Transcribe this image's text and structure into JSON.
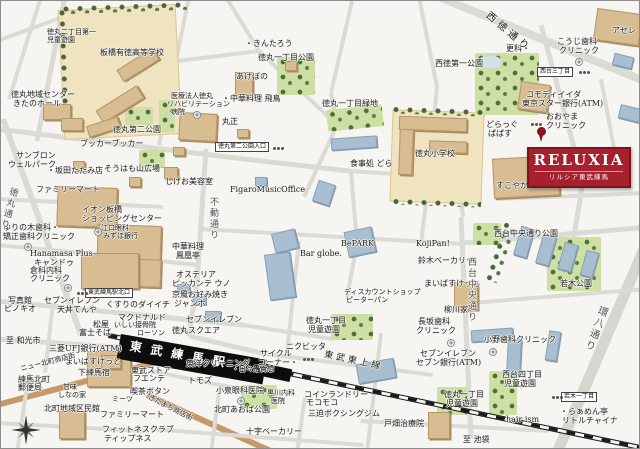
{
  "badge": {
    "title": "RELUXIA",
    "subtitle": "リルシア東武練馬",
    "bg": "#a6202e"
  },
  "station": {
    "name": "東武練馬駅"
  },
  "railway": {
    "name": "東武東上線",
    "dest_left": "至 和光市",
    "dest_right": "至 池袋"
  },
  "sign_boxes": [
    {
      "t": "東武練馬駅北口",
      "x": 84,
      "y": 287
    },
    {
      "t": "徳丸第二公園入口",
      "x": 214,
      "y": 141
    },
    {
      "t": "西台三丁目",
      "x": 536,
      "y": 66
    },
    {
      "t": "若木一丁目",
      "x": 560,
      "y": 391
    }
  ],
  "medical_icons": [
    [
      192,
      110
    ],
    [
      93,
      227
    ],
    [
      23,
      242
    ],
    [
      63,
      283
    ],
    [
      574,
      57
    ],
    [
      446,
      338
    ],
    [
      488,
      347
    ],
    [
      236,
      396
    ]
  ],
  "signal_icons": [
    [
      76,
      291
    ],
    [
      272,
      146
    ],
    [
      578,
      70
    ],
    [
      551,
      395
    ],
    [
      302,
      357
    ],
    [
      530,
      122
    ]
  ],
  "roads": [
    [
      438,
      -4,
      648,
      82,
      8,
      "g"
    ],
    [
      40,
      -4,
      8,
      98,
      4,
      "g"
    ],
    [
      -4,
      40,
      62,
      16,
      4,
      "g"
    ],
    [
      64,
      -4,
      36,
      140,
      5,
      "g"
    ],
    [
      188,
      -4,
      158,
      144,
      4,
      "g"
    ],
    [
      -4,
      128,
      226,
      156,
      5,
      "g"
    ],
    [
      226,
      156,
      348,
      170,
      5,
      "g"
    ],
    [
      348,
      170,
      442,
      176,
      4,
      "g"
    ],
    [
      160,
      62,
      258,
      50,
      4,
      "g"
    ],
    [
      225,
      -4,
      258,
      50,
      4,
      "g"
    ],
    [
      258,
      50,
      336,
      124,
      4,
      "g"
    ],
    [
      352,
      -4,
      330,
      92,
      4,
      "g"
    ],
    [
      330,
      92,
      336,
      124,
      4,
      "g"
    ],
    [
      336,
      124,
      303,
      196,
      4,
      "g"
    ],
    [
      205,
      148,
      196,
      282,
      5,
      "g"
    ],
    [
      196,
      282,
      188,
      335,
      5,
      "g"
    ],
    [
      436,
      84,
      428,
      176,
      4,
      "g"
    ],
    [
      428,
      176,
      420,
      243,
      4,
      "g"
    ],
    [
      540,
      24,
      582,
      180,
      5,
      "g"
    ],
    [
      582,
      180,
      572,
      242,
      5,
      "g"
    ],
    [
      418,
      -4,
      436,
      86,
      4,
      "g"
    ],
    [
      648,
      236,
      556,
      452,
      11,
      "w"
    ],
    [
      456,
      160,
      462,
      216,
      4,
      "g"
    ],
    [
      460,
      216,
      470,
      438,
      5,
      "g"
    ],
    [
      200,
      228,
      463,
      243,
      4,
      "g"
    ],
    [
      -4,
      244,
      82,
      252,
      4,
      "g"
    ],
    [
      82,
      252,
      197,
      264,
      4,
      "g"
    ],
    [
      -4,
      300,
      242,
      324,
      5,
      "g"
    ],
    [
      242,
      324,
      332,
      338,
      4,
      "g"
    ],
    [
      -4,
      338,
      128,
      347,
      5,
      "g"
    ],
    [
      -4,
      404,
      160,
      360,
      6,
      "b"
    ],
    [
      146,
      394,
      274,
      452,
      6,
      "b"
    ],
    [
      28,
      372,
      16,
      452,
      4,
      "g"
    ],
    [
      -4,
      422,
      142,
      430,
      4,
      "g"
    ],
    [
      52,
      302,
      44,
      372,
      4,
      "g"
    ],
    [
      150,
      370,
      258,
      392,
      4,
      "g"
    ],
    [
      218,
      392,
      210,
      452,
      4,
      "g"
    ],
    [
      150,
      428,
      362,
      444,
      4,
      "g"
    ],
    [
      304,
      396,
      296,
      452,
      4,
      "g"
    ],
    [
      298,
      240,
      286,
      352,
      4,
      "g"
    ],
    [
      350,
      170,
      356,
      243,
      4,
      "g"
    ],
    [
      356,
      243,
      346,
      296,
      4,
      "g"
    ],
    [
      462,
      242,
      648,
      226,
      5,
      "g"
    ],
    [
      470,
      302,
      645,
      288,
      4,
      "g"
    ],
    [
      495,
      198,
      648,
      192,
      4,
      "g"
    ],
    [
      600,
      78,
      620,
      184,
      4,
      "g"
    ],
    [
      -4,
      198,
      162,
      206,
      4,
      "g"
    ],
    [
      2,
      118,
      80,
      334,
      6,
      "g"
    ],
    [
      258,
      352,
      432,
      374,
      4,
      "g"
    ],
    [
      360,
      420,
      548,
      430,
      4,
      "g"
    ],
    [
      380,
      332,
      366,
      452,
      4,
      "g"
    ],
    [
      188,
      335,
      260,
      352,
      5,
      "g"
    ]
  ],
  "grounds": [
    [
      60,
      6,
      118,
      130,
      -3
    ],
    [
      390,
      110,
      92,
      92,
      2
    ]
  ],
  "parks": [
    [
      276,
      56,
      38,
      38,
      0
    ],
    [
      326,
      106,
      56,
      22,
      -6
    ],
    [
      474,
      52,
      64,
      62,
      0
    ],
    [
      124,
      106,
      28,
      18,
      0
    ],
    [
      138,
      149,
      26,
      18,
      0
    ],
    [
      472,
      222,
      28,
      22,
      0
    ],
    [
      546,
      236,
      54,
      54,
      0
    ],
    [
      240,
      384,
      36,
      24,
      0
    ],
    [
      330,
      313,
      42,
      26,
      0
    ],
    [
      436,
      386,
      30,
      28,
      0
    ],
    [
      488,
      370,
      28,
      44,
      0
    ],
    [
      158,
      99,
      16,
      32,
      0
    ]
  ],
  "tree_strips": [
    [
      60,
      2,
      126,
      9,
      -2
    ],
    [
      58,
      8,
      8,
      120,
      -2
    ],
    [
      390,
      106,
      94,
      8,
      2
    ],
    [
      390,
      198,
      90,
      7,
      2
    ],
    [
      492,
      220,
      16,
      62,
      18
    ]
  ],
  "ponds": [
    [
      478,
      55,
      22,
      12
    ]
  ],
  "buildings_tan": [
    [
      95,
      96,
      48,
      15,
      -32
    ],
    [
      116,
      57,
      42,
      14,
      -32
    ],
    [
      86,
      120,
      33,
      12,
      -18
    ],
    [
      398,
      116,
      68,
      14,
      2
    ],
    [
      398,
      128,
      14,
      46,
      2
    ],
    [
      428,
      140,
      38,
      12,
      2
    ],
    [
      42,
      103,
      28,
      16,
      0
    ],
    [
      60,
      117,
      22,
      13,
      0
    ],
    [
      178,
      112,
      38,
      28,
      3
    ],
    [
      56,
      186,
      60,
      40,
      2
    ],
    [
      96,
      224,
      64,
      46,
      2
    ],
    [
      118,
      258,
      42,
      28,
      2
    ],
    [
      80,
      252,
      58,
      36,
      0
    ],
    [
      492,
      156,
      66,
      40,
      -3
    ],
    [
      518,
      82,
      30,
      28,
      8
    ],
    [
      594,
      10,
      46,
      32,
      8
    ],
    [
      234,
      71,
      18,
      26,
      0
    ],
    [
      86,
      350,
      44,
      36,
      0
    ],
    [
      58,
      410,
      26,
      28,
      0
    ],
    [
      453,
      281,
      24,
      28,
      0
    ],
    [
      427,
      411,
      22,
      27,
      0
    ],
    [
      163,
      166,
      14,
      12,
      0
    ],
    [
      128,
      176,
      12,
      10,
      0
    ],
    [
      72,
      160,
      12,
      10,
      0
    ],
    [
      236,
      128,
      12,
      9,
      0
    ],
    [
      172,
      146,
      12,
      9,
      0
    ],
    [
      100,
      354,
      20,
      14,
      0
    ],
    [
      284,
      60,
      12,
      10,
      0
    ]
  ],
  "buildings_blue": [
    [
      266,
      252,
      26,
      46,
      -8
    ],
    [
      272,
      230,
      24,
      20,
      -14
    ],
    [
      314,
      181,
      18,
      22,
      18
    ],
    [
      330,
      136,
      46,
      12,
      -4
    ],
    [
      345,
      228,
      28,
      26,
      -12
    ],
    [
      516,
      226,
      14,
      30,
      16
    ],
    [
      538,
      234,
      14,
      30,
      16
    ],
    [
      560,
      242,
      14,
      28,
      16
    ],
    [
      582,
      250,
      13,
      26,
      16
    ],
    [
      470,
      328,
      42,
      12,
      -4
    ],
    [
      506,
      338,
      14,
      36,
      3
    ],
    [
      546,
      330,
      12,
      30,
      9
    ],
    [
      356,
      360,
      38,
      20,
      -10
    ],
    [
      204,
      310,
      16,
      10,
      0
    ],
    [
      176,
      283,
      13,
      9,
      0
    ],
    [
      192,
      295,
      13,
      9,
      0
    ],
    [
      618,
      106,
      26,
      14,
      14
    ],
    [
      612,
      54,
      20,
      12,
      14
    ],
    [
      254,
      176,
      12,
      9,
      0
    ]
  ],
  "labels": [
    {
      "t": "徳丸二丁目第一",
      "x": 46,
      "y": 28,
      "s": 7
    },
    {
      "t": "児童遊園",
      "x": 46,
      "y": 36,
      "s": 7
    },
    {
      "t": "板橋有徳高等学校",
      "x": 99,
      "y": 48
    },
    {
      "t": "徳丸地域センター",
      "x": 10,
      "y": 90
    },
    {
      "t": "きたのホール",
      "x": 12,
      "y": 99
    },
    {
      "t": "医療法人徳丸",
      "x": 170,
      "y": 92,
      "s": 7
    },
    {
      "t": "リハビリテーション",
      "x": 166,
      "y": 100,
      "s": 7
    },
    {
      "t": "病院",
      "x": 170,
      "y": 108,
      "s": 7
    },
    {
      "t": "徳丸第二公園",
      "x": 112,
      "y": 125
    },
    {
      "t": "ブッカーブッカー",
      "x": 79,
      "y": 139
    },
    {
      "t": "サンブロン",
      "x": 15,
      "y": 151
    },
    {
      "t": "ウェルパーク",
      "x": 7,
      "y": 160
    },
    {
      "t": "・坂田たたみ店",
      "x": 46,
      "y": 166
    },
    {
      "t": "そうはも山広場",
      "x": 103,
      "y": 164
    },
    {
      "t": "しげお美容室",
      "x": 164,
      "y": 177
    },
    {
      "t": "ファミリーマート",
      "x": 35,
      "y": 185
    },
    {
      "t": "イオン板橋",
      "x": 81,
      "y": 205
    },
    {
      "t": "ショッピングセンター",
      "x": 81,
      "y": 214
    },
    {
      "t": "江口眼科",
      "x": 100,
      "y": 224,
      "s": 7
    },
    {
      "t": "みずほ銀行",
      "x": 102,
      "y": 232,
      "s": 7
    },
    {
      "t": "ゆりの木歯科・",
      "x": 2,
      "y": 223
    },
    {
      "t": "矯正歯科クリニック",
      "x": 2,
      "y": 232
    },
    {
      "t": "Hanamasa Plus",
      "x": 29,
      "y": 249,
      "c": "en"
    },
    {
      "t": "キャンドゥ",
      "x": 33,
      "y": 258
    },
    {
      "t": "倉科内科",
      "x": 29,
      "y": 266
    },
    {
      "t": "クリニック",
      "x": 29,
      "y": 274
    },
    {
      "t": "写真館",
      "x": 7,
      "y": 296
    },
    {
      "t": "ピノキオ",
      "x": 3,
      "y": 304
    },
    {
      "t": "セブンイレブン",
      "x": 43,
      "y": 296
    },
    {
      "t": "天丼てんや",
      "x": 56,
      "y": 305
    },
    {
      "t": "くすりのダイイチ",
      "x": 105,
      "y": 300
    },
    {
      "t": "マクドナルド",
      "x": 117,
      "y": 313
    },
    {
      "t": "いしい接骨院",
      "x": 113,
      "y": 321,
      "s": 7
    },
    {
      "t": "松屋",
      "x": 92,
      "y": 320
    },
    {
      "t": "富士そば",
      "x": 78,
      "y": 328
    },
    {
      "t": "ローソン",
      "x": 136,
      "y": 329,
      "s": 7
    },
    {
      "t": "三菱UFJ銀行(ATM)",
      "x": 48,
      "y": 344
    },
    {
      "t": "まいばすけっと",
      "x": 64,
      "y": 357
    },
    {
      "t": "下練馬宿",
      "x": 77,
      "y": 368
    },
    {
      "t": "練馬北町",
      "x": 17,
      "y": 375
    },
    {
      "t": "郵便局",
      "x": 17,
      "y": 383
    },
    {
      "t": "甘味",
      "x": 62,
      "y": 383,
      "s": 7
    },
    {
      "t": "しなの家",
      "x": 57,
      "y": 391,
      "s": 7
    },
    {
      "t": "北町地域区民館",
      "x": 43,
      "y": 404
    },
    {
      "t": "ミーツ",
      "x": 111,
      "y": 395,
      "s": 7
    },
    {
      "t": "ファミリーマート",
      "x": 99,
      "y": 410
    },
    {
      "t": "フィットネスクラブ",
      "x": 101,
      "y": 425
    },
    {
      "t": "ティップネス",
      "x": 103,
      "y": 434
    },
    {
      "t": "東武ストア",
      "x": 130,
      "y": 366
    },
    {
      "t": "フエンテ",
      "x": 132,
      "y": 374
    },
    {
      "t": "喫茶ボタン",
      "x": 129,
      "y": 387
    },
    {
      "t": "トモズ",
      "x": 187,
      "y": 376
    },
    {
      "t": "東洋クリーニング",
      "x": 185,
      "y": 359
    },
    {
      "t": "小泉眼科医院",
      "x": 215,
      "y": 386
    },
    {
      "t": "北町あおば公園",
      "x": 213,
      "y": 405
    },
    {
      "t": "黒川内科",
      "x": 266,
      "y": 389,
      "s": 7
    },
    {
      "t": "医院",
      "x": 270,
      "y": 397,
      "s": 7
    },
    {
      "t": "コインランドリー",
      "x": 303,
      "y": 390
    },
    {
      "t": "モコモコ",
      "x": 305,
      "y": 398
    },
    {
      "t": "三迫ボクシングジム",
      "x": 307,
      "y": 409
    },
    {
      "t": "十字ベーカリー",
      "x": 245,
      "y": 427
    },
    {
      "t": "・日々是貴想",
      "x": 231,
      "y": 365,
      "s": 7
    },
    {
      "t": "サイクル",
      "x": 259,
      "y": 349
    },
    {
      "t": "コーナー・",
      "x": 257,
      "y": 358
    },
    {
      "t": "ニクビッタ",
      "x": 285,
      "y": 342
    },
    {
      "t": "徳丸スクエア",
      "x": 171,
      "y": 326
    },
    {
      "t": "セブンイレブン",
      "x": 185,
      "y": 315
    },
    {
      "t": "京風お好み焼き",
      "x": 171,
      "y": 290
    },
    {
      "t": "ジャンボ",
      "x": 173,
      "y": 299
    },
    {
      "t": "オステリア",
      "x": 175,
      "y": 270
    },
    {
      "t": "ピッカンテ ウノ",
      "x": 171,
      "y": 279
    },
    {
      "t": "中華料理",
      "x": 171,
      "y": 242
    },
    {
      "t": "鳳凰亭",
      "x": 175,
      "y": 251
    },
    {
      "t": "FigaroMusicOffice",
      "x": 229,
      "y": 185,
      "c": "en"
    },
    {
      "t": "Bar globe.",
      "x": 299,
      "y": 249,
      "c": "en"
    },
    {
      "t": "BePARK",
      "x": 340,
      "y": 239,
      "c": "en"
    },
    {
      "t": "KojiPan!",
      "x": 415,
      "y": 239,
      "c": "en"
    },
    {
      "t": "ディスカウントショップ",
      "x": 343,
      "y": 288,
      "s": 7
    },
    {
      "t": "ピーターパン",
      "x": 345,
      "y": 296,
      "s": 7
    },
    {
      "t": "徳丸一丁目",
      "x": 305,
      "y": 316
    },
    {
      "t": "児童遊園",
      "x": 307,
      "y": 325
    },
    {
      "t": "・きんたろう",
      "x": 244,
      "y": 39
    },
    {
      "t": "徳丸一丁目公園",
      "x": 257,
      "y": 53
    },
    {
      "t": "あけぼの",
      "x": 235,
      "y": 72
    },
    {
      "t": "・中華料理 飛鳥",
      "x": 221,
      "y": 94
    },
    {
      "t": "丸正",
      "x": 221,
      "y": 117
    },
    {
      "t": "徳丸一丁目緑地",
      "x": 321,
      "y": 99
    },
    {
      "t": "食事処 どら",
      "x": 349,
      "y": 159
    },
    {
      "t": "徳丸小学校",
      "x": 414,
      "y": 149
    },
    {
      "t": "どらっぐ",
      "x": 485,
      "y": 120
    },
    {
      "t": "ぱぱす",
      "x": 487,
      "y": 129
    },
    {
      "t": "更科・",
      "x": 505,
      "y": 44
    },
    {
      "t": "こうじ歯科",
      "x": 556,
      "y": 37
    },
    {
      "t": "クリニック",
      "x": 558,
      "y": 46
    },
    {
      "t": "西徳第一公園",
      "x": 434,
      "y": 59
    },
    {
      "t": "アゼレ",
      "x": 611,
      "y": 26
    },
    {
      "t": "コモディイイダ",
      "x": 525,
      "y": 90
    },
    {
      "t": "東京スター銀行(ATM)",
      "x": 521,
      "y": 99
    },
    {
      "t": "おおやま",
      "x": 545,
      "y": 112
    },
    {
      "t": "クリニック",
      "x": 545,
      "y": 121
    },
    {
      "t": "すこやかプラザ",
      "x": 495,
      "y": 181
    },
    {
      "t": "西台中央通り公園",
      "x": 493,
      "y": 229
    },
    {
      "t": "若木公園",
      "x": 559,
      "y": 279
    },
    {
      "t": "鈴木ベーカリー",
      "x": 417,
      "y": 256
    },
    {
      "t": "まいばすけっと",
      "x": 423,
      "y": 279
    },
    {
      "t": "柳川家・",
      "x": 443,
      "y": 305
    },
    {
      "t": "長坂歯科",
      "x": 417,
      "y": 317
    },
    {
      "t": "クリニック",
      "x": 415,
      "y": 326
    },
    {
      "t": "小野歯科クリニック",
      "x": 483,
      "y": 335
    },
    {
      "t": "セブンイレブン",
      "x": 419,
      "y": 349
    },
    {
      "t": "セブン銀行(ATM)",
      "x": 415,
      "y": 358
    },
    {
      "t": "西台四丁目",
      "x": 501,
      "y": 370
    },
    {
      "t": "児童遊園",
      "x": 503,
      "y": 379
    },
    {
      "t": "徳丸一丁目",
      "x": 443,
      "y": 390
    },
    {
      "t": "児童遊園",
      "x": 445,
      "y": 399
    },
    {
      "t": "hair ism",
      "x": 505,
      "y": 415,
      "c": "en"
    },
    {
      "t": "・らぁめん亭",
      "x": 559,
      "y": 407
    },
    {
      "t": "リトルチャイナ",
      "x": 561,
      "y": 416
    },
    {
      "t": "戸畑治療院",
      "x": 383,
      "y": 419
    },
    {
      "t": "不動通り",
      "x": 207,
      "y": 196,
      "s": 9,
      "v": 1
    },
    {
      "t": "西台中央通り",
      "x": 465,
      "y": 256,
      "s": 9,
      "v": 1
    },
    {
      "t": "徳丸通り",
      "x": 8,
      "y": 185,
      "s": 9,
      "v": 1,
      "r": 15
    },
    {
      "t": "環八通り",
      "x": 597,
      "y": 303,
      "s": 10,
      "v": 1,
      "r": 20
    },
    {
      "t": "西徳通り",
      "x": 489,
      "y": 10,
      "s": 10,
      "r": 40,
      "ls": 4
    },
    {
      "t": "東武東上線",
      "x": 324,
      "y": 350,
      "s": 9,
      "r": 12,
      "ls": 3
    },
    {
      "t": "きたまち商店街",
      "x": 149,
      "y": 393,
      "s": 7,
      "r": 27
    },
    {
      "t": "ニュー北町商店街",
      "x": 19,
      "y": 365,
      "s": 7,
      "r": -14
    }
  ]
}
